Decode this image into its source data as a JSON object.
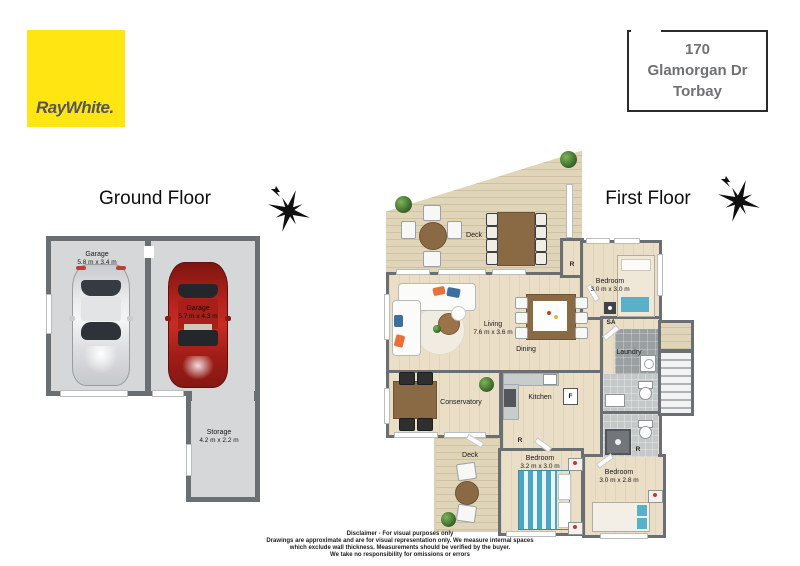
{
  "colors": {
    "brandYellow": "#FFE512",
    "brandText": "#54565A",
    "wall": "#6A6F74",
    "floorWood": "#EADFC6",
    "deckWood": "#E0D5B8",
    "garageFloor": "#D6D7D9",
    "tileGray": "#9AA0A2",
    "bathGray": "#C4C8C9"
  },
  "brand": {
    "logo": "RayWhite."
  },
  "address": {
    "lines": [
      "170",
      "Glamorgan Dr",
      "Torbay"
    ]
  },
  "ground_floor": {
    "title": "Ground Floor",
    "rooms": {
      "garage_left": {
        "name": "Garage",
        "dims": "5.8 m x 3.4 m"
      },
      "garage_right": {
        "name": "Garage",
        "dims": "5.7 m x 4.3 m"
      },
      "storage": {
        "name": "Storage",
        "dims": "4.2 m x 2.2 m"
      }
    }
  },
  "first_floor": {
    "title": "First Floor",
    "rooms": {
      "deck_top": {
        "name": "Deck"
      },
      "living": {
        "name": "Living",
        "dims": "7.6 m x 3.6 m"
      },
      "dining": {
        "name": "Dining"
      },
      "conservatory": {
        "name": "Conservatory"
      },
      "kitchen": {
        "name": "Kitchen"
      },
      "laundry": {
        "name": "Laundry"
      },
      "bedroom_top": {
        "name": "Bedroom",
        "dims": "3.0 m x 3.0 m"
      },
      "bedroom_mid": {
        "name": "Bedroom",
        "dims": "3.2 m x 3.0 m"
      },
      "bedroom_right": {
        "name": "Bedroom",
        "dims": "3.0 m x 2.8 m"
      },
      "deck_bottom": {
        "name": "Deck"
      }
    },
    "markers": {
      "robe1": "R",
      "sa": "SA",
      "fridge": "F",
      "robe2": "R",
      "robe3": "R"
    }
  },
  "disclaimer": {
    "lines": [
      "Disclaimer - For visual purposes only",
      "Drawings are approximate and are for visual representation only. We measure internal spaces",
      "which exclude wall thickness. Measurements should be verified by the buyer.",
      "We take no responsibility for omissions or errors"
    ]
  }
}
